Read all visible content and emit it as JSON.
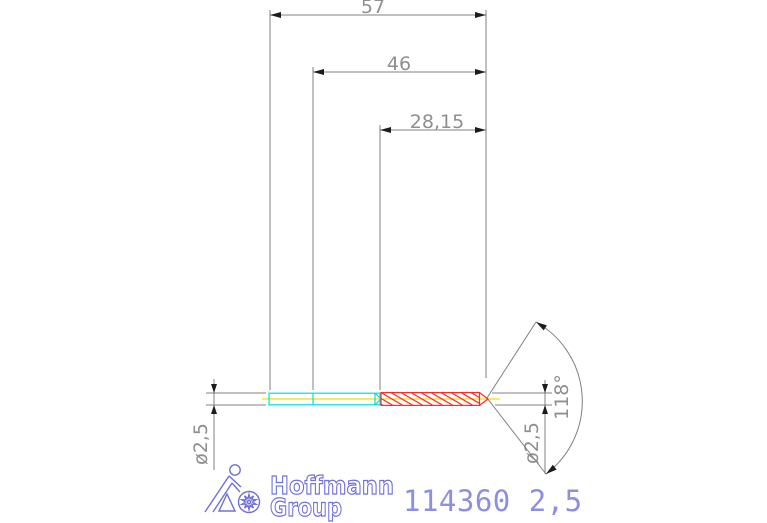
{
  "dimensions": {
    "total_length": "57",
    "body_length": "46",
    "flute_length": "28,15",
    "diameter_left": "ø2,5",
    "diameter_right": "ø2,5",
    "point_angle": "118°"
  },
  "branding": {
    "logo_line1": "Hoffmann",
    "logo_line2": "Group"
  },
  "part_number": "114360 2,5",
  "colors": {
    "dimension_line": "#808080",
    "dimension_text": "#8f8f8f",
    "arrow": "#1c1c1c",
    "shank": "#00dfdf",
    "centerline": "#f0e000",
    "flute": "#ff2a2a",
    "logo": "#7070d8",
    "part_number": "#8f8fe0"
  }
}
